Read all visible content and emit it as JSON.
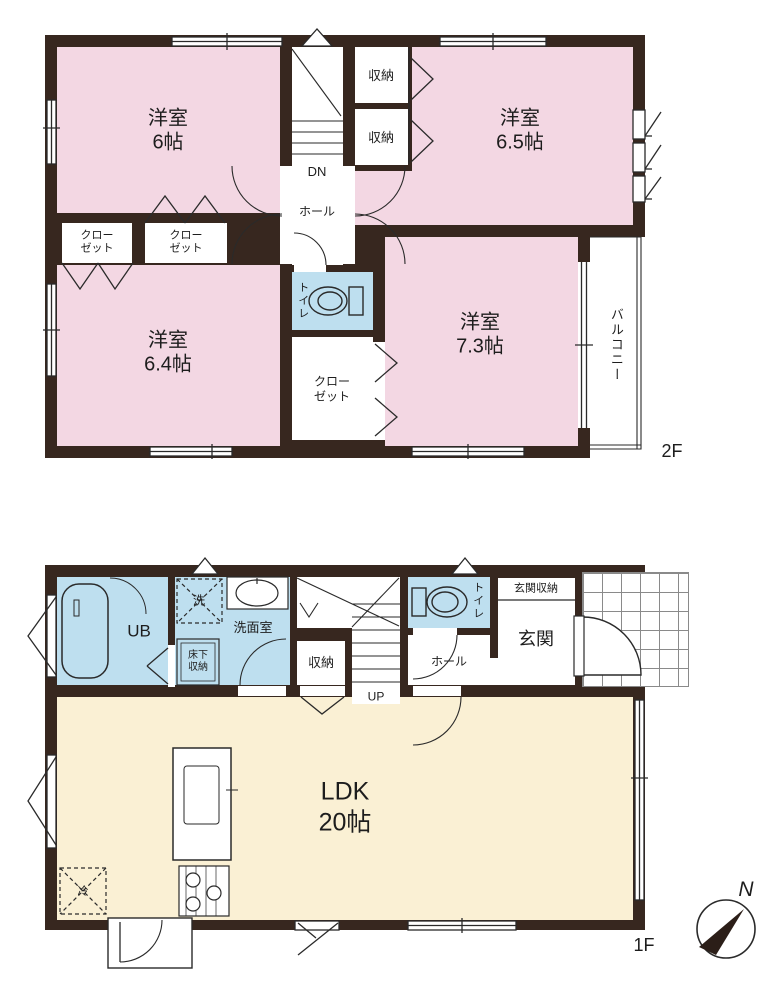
{
  "colors": {
    "wall": "#37271f",
    "room_pink": "#f3d7e3",
    "room_blue": "#bedfef",
    "room_cream": "#faf0d4",
    "background": "#ffffff",
    "line": "#2a2a2a"
  },
  "floor2": {
    "label": "2F",
    "room_yoshitsu_6": {
      "name": "洋室",
      "size": "6帖"
    },
    "room_yoshitsu_65": {
      "name": "洋室",
      "size": "6.5帖"
    },
    "room_yoshitsu_64": {
      "name": "洋室",
      "size": "6.4帖"
    },
    "room_yoshitsu_73": {
      "name": "洋室",
      "size": "7.3帖"
    },
    "storage_top": "収納",
    "storage_bottom": "収納",
    "closet_small_1": {
      "line1": "クロー",
      "line2": "ゼット"
    },
    "closet_small_2": {
      "line1": "クロー",
      "line2": "ゼット"
    },
    "closet_center": {
      "line1": "クロー",
      "line2": "ゼット"
    },
    "hall": "ホール",
    "stairs_down": "DN",
    "toilet": "トイレ",
    "balcony": "バルコニー"
  },
  "floor1": {
    "label": "1F",
    "unit_bath": "UB",
    "washer": "洗",
    "washroom": "洗面室",
    "underfloor_storage": {
      "line1": "床下",
      "line2": "収納"
    },
    "storage": "収納",
    "stairs_up": "UP",
    "toilet": "トイレ",
    "hall": "ホール",
    "entrance_storage": "玄関収納",
    "entrance": "玄関",
    "ldk": {
      "name": "LDK",
      "size": "20帖"
    },
    "refrigerator": "冷"
  },
  "compass": {
    "north": "N"
  }
}
